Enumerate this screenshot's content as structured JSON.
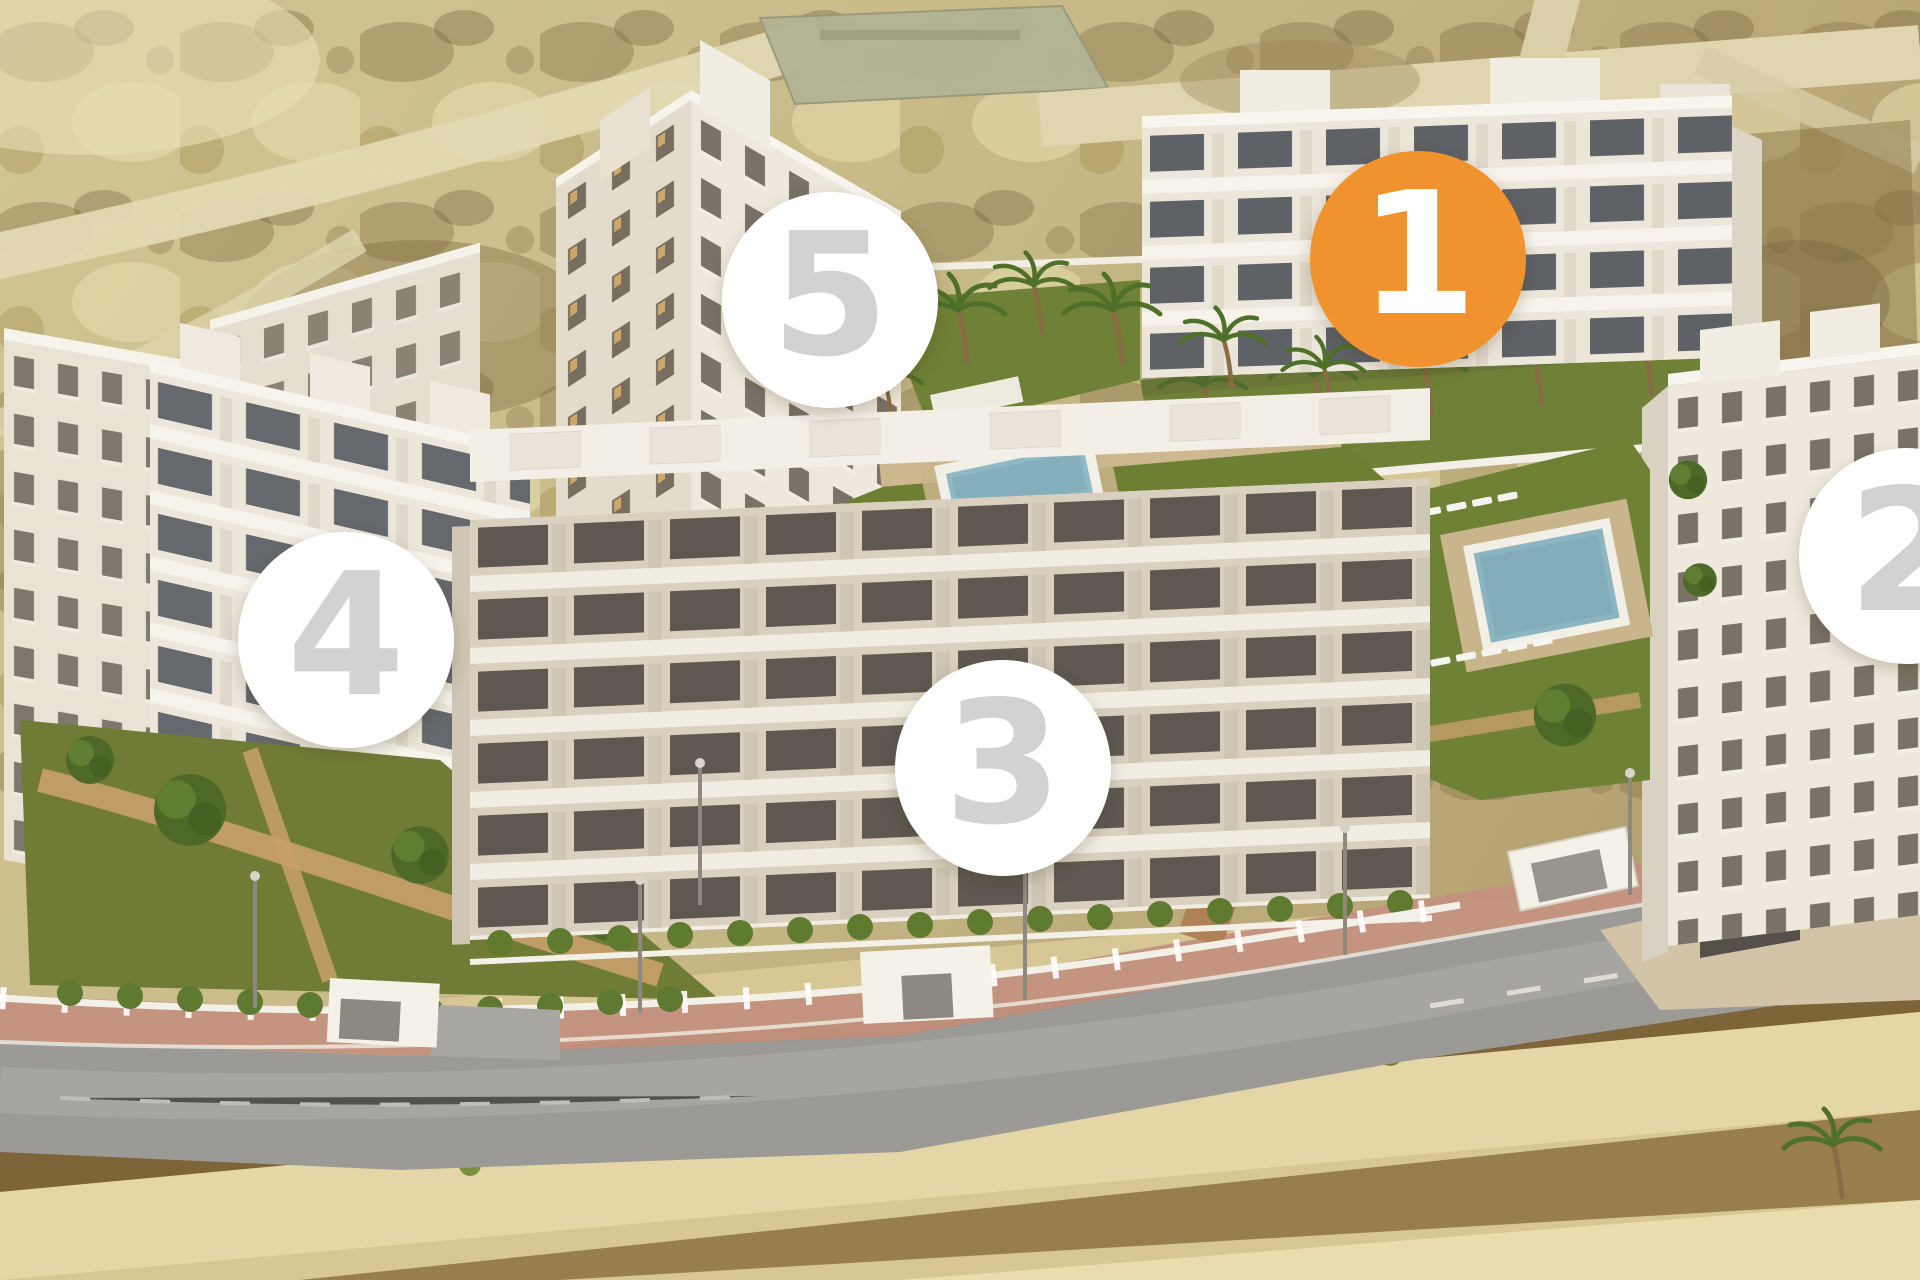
{
  "view": {
    "title": "residential-development-aerial-view",
    "width": 1920,
    "height": 1280
  },
  "markers": {
    "selected_color": "#F0922E",
    "default_color": "#FFFFFF",
    "selected_number_color": "#FFFFFF",
    "default_number_color": "#D2D2D2",
    "items": [
      {
        "label": "1",
        "x": 1418,
        "y": 259,
        "diameter": 216,
        "selected": true
      },
      {
        "label": "2",
        "x": 1907,
        "y": 556,
        "diameter": 216,
        "selected": false
      },
      {
        "label": "3",
        "x": 1003,
        "y": 768,
        "diameter": 216,
        "selected": false
      },
      {
        "label": "4",
        "x": 346,
        "y": 640,
        "diameter": 216,
        "selected": false
      },
      {
        "label": "5",
        "x": 830,
        "y": 300,
        "diameter": 216,
        "selected": false
      }
    ]
  },
  "palette": {
    "accent_orange": "#F0922E",
    "marker_white": "#FFFFFF",
    "marker_number_gray": "#D2D2D2",
    "lawn_green": "#6E8134",
    "pool_blue": "#8BB5C0",
    "road_gray": "#9C9A96",
    "sidewalk_brick": "#C4917F",
    "sand": "#D7C795",
    "soil_brown": "#74592F",
    "building_light": "#EFE9DE",
    "building_shadow": "#D9D1C2"
  }
}
